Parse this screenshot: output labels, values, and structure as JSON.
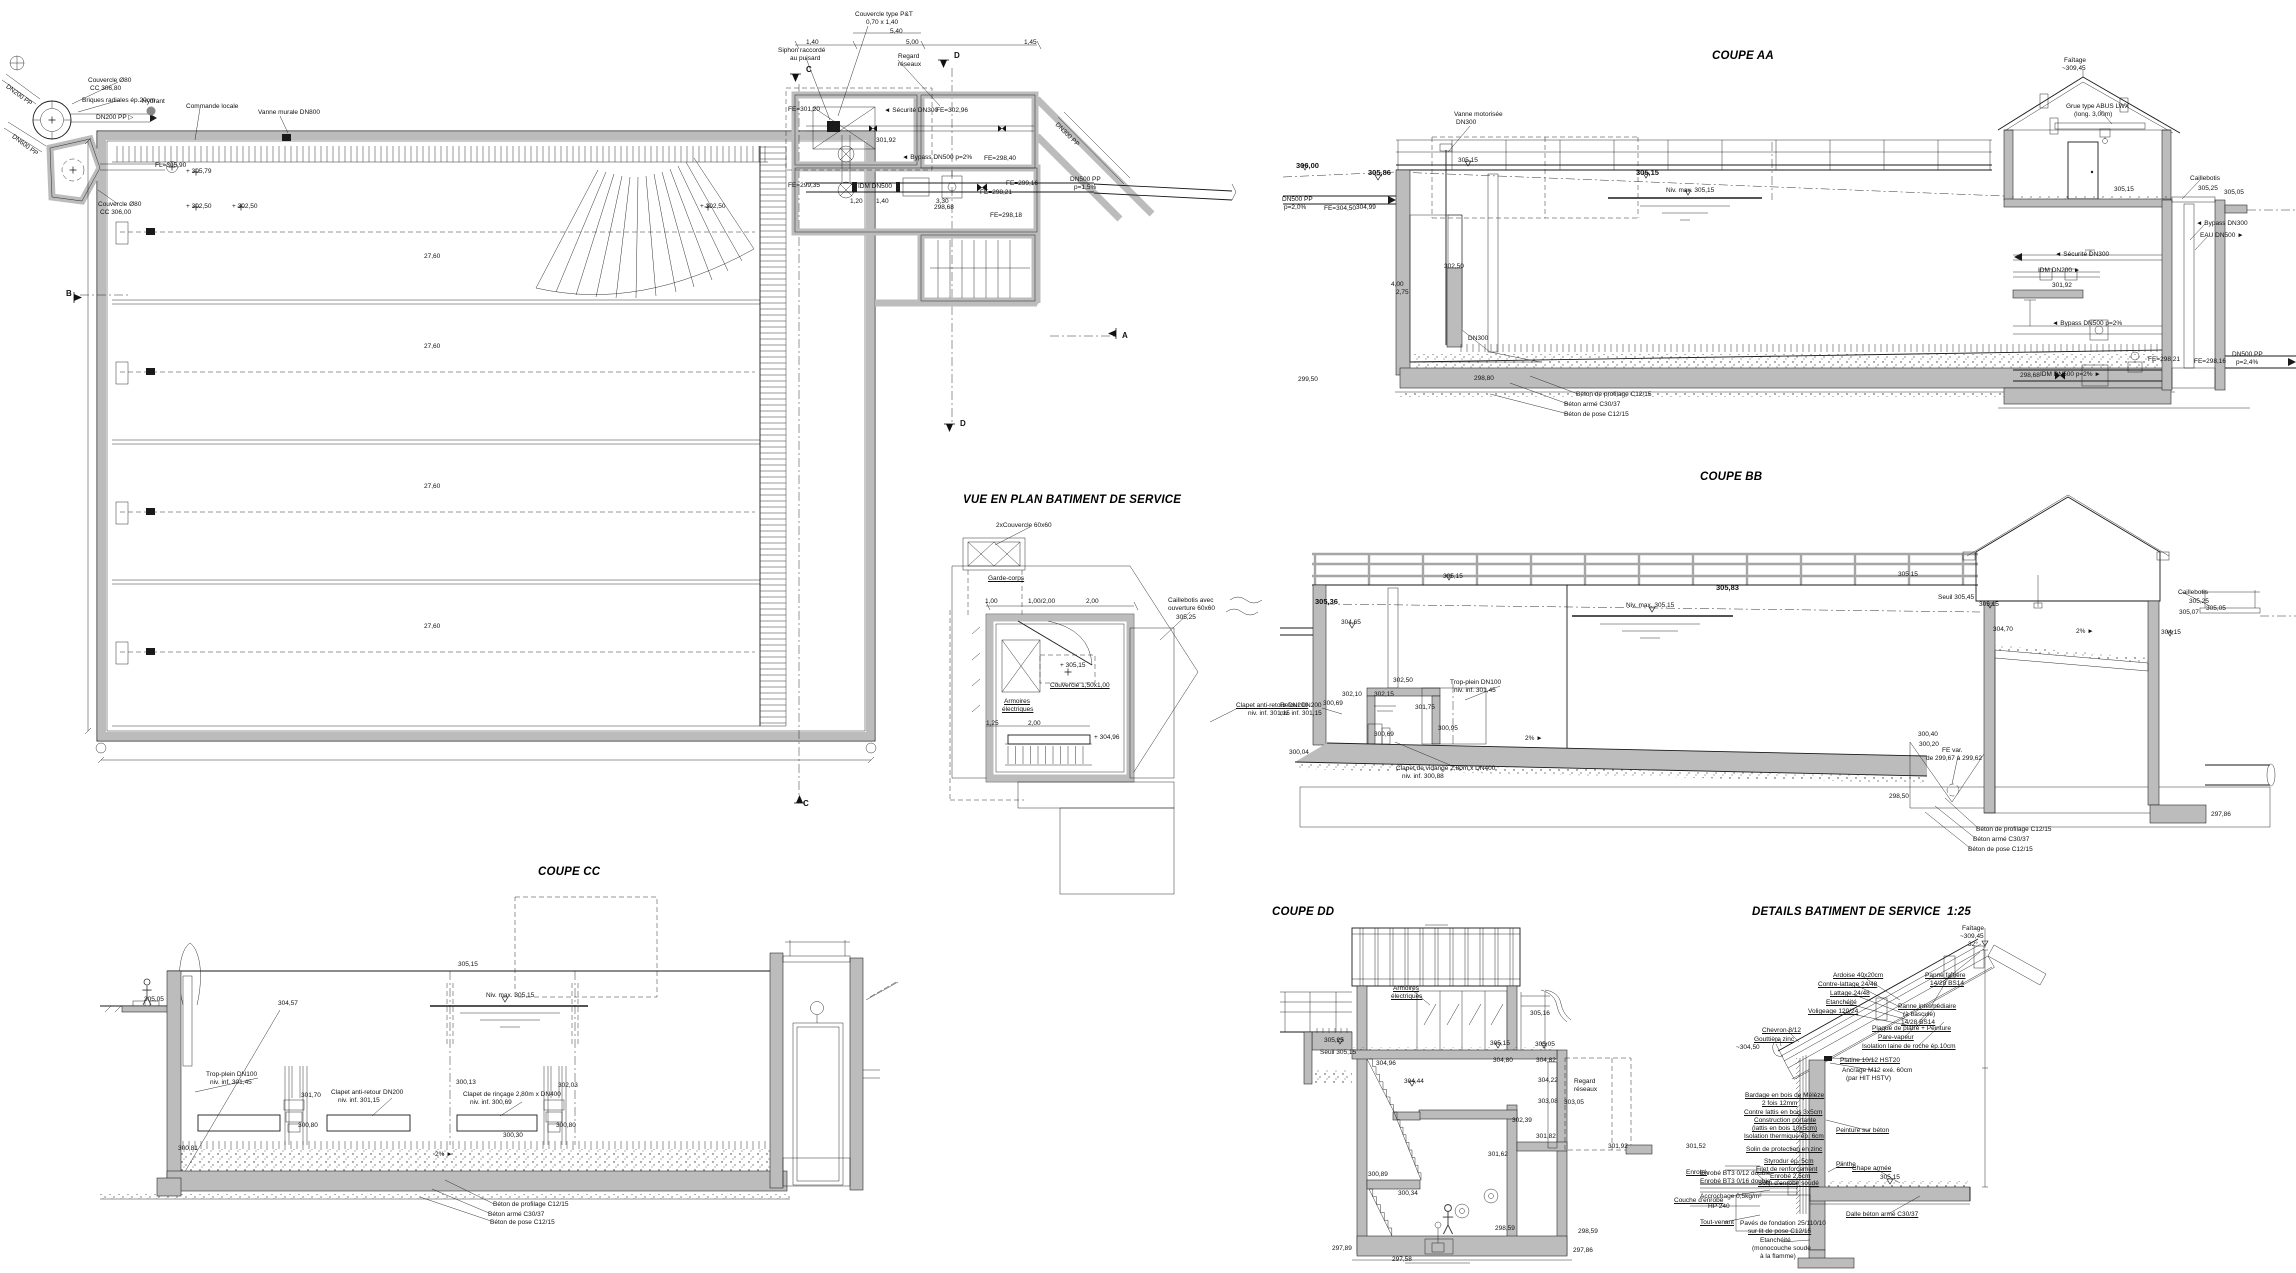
{
  "meta": {
    "paper_color": "#ffffff",
    "ink_color": "#1a1a1a",
    "concrete_color": "#bcbcbc",
    "railing_color": "#a6a6a6",
    "drawing_type": "water reservoir / basin construction drawing"
  },
  "titles": {
    "coupe_aa": "COUPE AA",
    "coupe_bb": "COUPE BB",
    "coupe_cc": "COUPE CC",
    "coupe_dd": "COUPE DD",
    "vue_plan_service": "VUE EN PLAN BATIMENT DE SERVICE",
    "details_service": "DETAILS BATIMENT DE SERVICE  1:25"
  },
  "annotations": [
    {
      "t": "Couvercle Ø80",
      "x": 88,
      "y": 78
    },
    {
      "t": "CC 306,80",
      "x": 90,
      "y": 86
    },
    {
      "t": "Briques radiales ép.20cm",
      "x": 82,
      "y": 98
    },
    {
      "t": "Hydrant",
      "x": 142,
      "y": 99
    },
    {
      "t": "Commande locale",
      "x": 186,
      "y": 104
    },
    {
      "t": "Vanne murale DN800",
      "x": 258,
      "y": 110
    },
    {
      "t": "DN200 PP ▷",
      "x": 96,
      "y": 115
    },
    {
      "t": "DN200 PP",
      "x": 8,
      "y": 84,
      "r": 37
    },
    {
      "t": "DN600 PP",
      "x": 14,
      "y": 134,
      "r": 37
    },
    {
      "t": "Couvercle Ø80",
      "x": 98,
      "y": 202
    },
    {
      "t": "CC 306,00",
      "x": 100,
      "y": 210
    },
    {
      "t": "FL=305,90",
      "x": 155,
      "y": 163
    },
    {
      "t": "+ 305,79",
      "x": 186,
      "y": 169
    },
    {
      "t": "+ 302,50",
      "x": 186,
      "y": 204
    },
    {
      "t": "+ 302,50",
      "x": 232,
      "y": 204
    },
    {
      "t": "+ 302,50",
      "x": 700,
      "y": 204
    },
    {
      "t": "27,60",
      "x": 424,
      "y": 254
    },
    {
      "t": "27,60",
      "x": 424,
      "y": 344
    },
    {
      "t": "27,60",
      "x": 424,
      "y": 484
    },
    {
      "t": "27,60",
      "x": 424,
      "y": 624
    },
    {
      "t": "B",
      "x": 66,
      "y": 290,
      "b": true,
      "s": 8
    },
    {
      "t": "A",
      "x": 1122,
      "y": 332,
      "b": true,
      "s": 8
    },
    {
      "t": "C",
      "x": 806,
      "y": 66,
      "b": true,
      "s": 8
    },
    {
      "t": "D",
      "x": 954,
      "y": 52,
      "b": true,
      "s": 8
    },
    {
      "t": "D",
      "x": 960,
      "y": 420,
      "b": true,
      "s": 8
    },
    {
      "t": "C",
      "x": 803,
      "y": 800,
      "b": true,
      "s": 8
    },
    {
      "t": "Couvercle type P&T",
      "x": 855,
      "y": 12
    },
    {
      "t": "0,70 x 1,40",
      "x": 866,
      "y": 20
    },
    {
      "t": "5,40",
      "x": 890,
      "y": 29
    },
    {
      "t": "1,40",
      "x": 806,
      "y": 40
    },
    {
      "t": "5,00",
      "x": 906,
      "y": 40
    },
    {
      "t": "1,45",
      "x": 1024,
      "y": 40
    },
    {
      "t": "Siphon raccordé",
      "x": 778,
      "y": 48
    },
    {
      "t": "au puisard",
      "x": 790,
      "y": 56
    },
    {
      "t": "Regard",
      "x": 898,
      "y": 54
    },
    {
      "t": "réseaux",
      "x": 898,
      "y": 62
    },
    {
      "t": "FE=301,20",
      "x": 788,
      "y": 107
    },
    {
      "t": "◄ Sécurité DN300",
      "x": 884,
      "y": 108
    },
    {
      "t": "FE=302,96",
      "x": 936,
      "y": 108
    },
    {
      "t": "301,92",
      "x": 876,
      "y": 138
    },
    {
      "t": "◄ Bypass DN500 p=2%",
      "x": 902,
      "y": 155
    },
    {
      "t": "FE=299,35",
      "x": 788,
      "y": 183
    },
    {
      "t": "IDM DN500",
      "x": 858,
      "y": 184
    },
    {
      "t": "FE=298,40",
      "x": 984,
      "y": 156
    },
    {
      "t": "FE=298,21",
      "x": 980,
      "y": 190
    },
    {
      "t": "FE=299,16",
      "x": 1006,
      "y": 181
    },
    {
      "t": "FE=298,18",
      "x": 990,
      "y": 213
    },
    {
      "t": "298,68",
      "x": 934,
      "y": 205
    },
    {
      "t": "1,20",
      "x": 850,
      "y": 199
    },
    {
      "t": "1,40",
      "x": 876,
      "y": 199
    },
    {
      "t": "3,30",
      "x": 936,
      "y": 199
    },
    {
      "t": "DN500 PP",
      "x": 1070,
      "y": 177
    },
    {
      "t": "p=1,5%",
      "x": 1074,
      "y": 185
    },
    {
      "t": "DN300 PP",
      "x": 1058,
      "y": 122,
      "r": 45
    },
    {
      "t": "2xCouvercle 60x60",
      "x": 996,
      "y": 523
    },
    {
      "t": "Garde-corps",
      "x": 988,
      "y": 576,
      "u": true
    },
    {
      "t": "Caillebotis avec",
      "x": 1168,
      "y": 598
    },
    {
      "t": "ouverture 60x60",
      "x": 1168,
      "y": 606
    },
    {
      "t": "305,25",
      "x": 1176,
      "y": 615
    },
    {
      "t": "1,00",
      "x": 985,
      "y": 599
    },
    {
      "t": "1,00/2,00",
      "x": 1028,
      "y": 599
    },
    {
      "t": "2,00",
      "x": 1086,
      "y": 599
    },
    {
      "t": "+ 305,15",
      "x": 1060,
      "y": 663
    },
    {
      "t": "Couvercle 1,50x1,00",
      "x": 1050,
      "y": 683,
      "u": true
    },
    {
      "t": "Armoires",
      "x": 1004,
      "y": 699,
      "u": true
    },
    {
      "t": "électriques",
      "x": 1002,
      "y": 707,
      "u": true
    },
    {
      "t": "1,25",
      "x": 986,
      "y": 721
    },
    {
      "t": "2,00",
      "x": 1028,
      "y": 721
    },
    {
      "t": "+ 304,96",
      "x": 1094,
      "y": 735
    },
    {
      "t": "Clapet anti-retour DN200",
      "x": 1236,
      "y": 703,
      "u": true
    },
    {
      "t": "niv. inf. 301,15",
      "x": 1248,
      "y": 711
    },
    {
      "t": "Vanne motorisée",
      "x": 1454,
      "y": 112
    },
    {
      "t": "DN300",
      "x": 1456,
      "y": 120
    },
    {
      "t": "306,00",
      "x": 1296,
      "y": 162,
      "b": true
    },
    {
      "t": "305,86",
      "x": 1368,
      "y": 169,
      "b": true
    },
    {
      "t": "305,15",
      "x": 1458,
      "y": 158
    },
    {
      "t": "305,15",
      "x": 1636,
      "y": 169,
      "b": true
    },
    {
      "t": "Niv. max. 305,15",
      "x": 1666,
      "y": 188
    },
    {
      "t": "DN500 PP",
      "x": 1282,
      "y": 197
    },
    {
      "t": "p=2,0%",
      "x": 1284,
      "y": 205
    },
    {
      "t": "FE=304,50",
      "x": 1324,
      "y": 206
    },
    {
      "t": "304,99",
      "x": 1356,
      "y": 205
    },
    {
      "t": "302,50",
      "x": 1444,
      "y": 264
    },
    {
      "t": "4,00",
      "x": 1391,
      "y": 282
    },
    {
      "t": "2,75",
      "x": 1396,
      "y": 290
    },
    {
      "t": "DN300",
      "x": 1468,
      "y": 336
    },
    {
      "t": "299,50",
      "x": 1298,
      "y": 377
    },
    {
      "t": "298,80",
      "x": 1474,
      "y": 376
    },
    {
      "t": "Béton de profilage C12/15",
      "x": 1576,
      "y": 392
    },
    {
      "t": "Béton armé C30/37",
      "x": 1564,
      "y": 402
    },
    {
      "t": "Béton de pose C12/15",
      "x": 1564,
      "y": 412
    },
    {
      "t": "Faîtage",
      "x": 2064,
      "y": 58
    },
    {
      "t": "~309,45",
      "x": 2062,
      "y": 66
    },
    {
      "t": "Grue type ABUS LWX",
      "x": 2066,
      "y": 104
    },
    {
      "t": "(long. 3,00m)",
      "x": 2074,
      "y": 112
    },
    {
      "t": "Caillebotis",
      "x": 2190,
      "y": 176
    },
    {
      "t": "305,15",
      "x": 2114,
      "y": 187
    },
    {
      "t": "305,25",
      "x": 2198,
      "y": 186
    },
    {
      "t": "305,05",
      "x": 2224,
      "y": 190
    },
    {
      "t": "◄ Sécurité DN300",
      "x": 2055,
      "y": 252
    },
    {
      "t": "IDM DN200 ►",
      "x": 2038,
      "y": 268
    },
    {
      "t": "301,92",
      "x": 2052,
      "y": 283
    },
    {
      "t": "◄ Bypass DN500 p=2%",
      "x": 2052,
      "y": 321
    },
    {
      "t": "◄ Bypass DN300",
      "x": 2196,
      "y": 221
    },
    {
      "t": "EAU DN500 ►",
      "x": 2200,
      "y": 233
    },
    {
      "t": "IDM DN500 p=2% ►",
      "x": 2040,
      "y": 372
    },
    {
      "t": "298,68",
      "x": 2020,
      "y": 373
    },
    {
      "t": "FE=298,21",
      "x": 2148,
      "y": 357
    },
    {
      "t": "FE=298,16",
      "x": 2194,
      "y": 359
    },
    {
      "t": "DN500 PP",
      "x": 2232,
      "y": 352
    },
    {
      "t": "p=2,4%",
      "x": 2236,
      "y": 360
    },
    {
      "t": "305,15",
      "x": 1443,
      "y": 574
    },
    {
      "t": "305,36",
      "x": 1315,
      "y": 598,
      "b": true
    },
    {
      "t": "Niv. max. 305,15",
      "x": 1626,
      "y": 603
    },
    {
      "t": "305,83",
      "x": 1716,
      "y": 584,
      "b": true
    },
    {
      "t": "304,65",
      "x": 1341,
      "y": 620
    },
    {
      "t": "302,50",
      "x": 1393,
      "y": 678
    },
    {
      "t": "Trop-plein DN100",
      "x": 1450,
      "y": 680
    },
    {
      "t": "niv. inf. 301,45",
      "x": 1454,
      "y": 688
    },
    {
      "t": "302,10",
      "x": 1342,
      "y": 692
    },
    {
      "t": "302,15",
      "x": 1374,
      "y": 692
    },
    {
      "t": "300,69",
      "x": 1323,
      "y": 701
    },
    {
      "t": "Retour DN200",
      "x": 1280,
      "y": 703
    },
    {
      "t": "niv. inf. 301,15",
      "x": 1280,
      "y": 711
    },
    {
      "t": "301,75",
      "x": 1415,
      "y": 705
    },
    {
      "t": "300,95",
      "x": 1438,
      "y": 726
    },
    {
      "t": "300,69",
      "x": 1374,
      "y": 732
    },
    {
      "t": "2% ►",
      "x": 1525,
      "y": 736
    },
    {
      "t": "300,04",
      "x": 1289,
      "y": 750
    },
    {
      "t": "Clapet de vidange 2,80m x DN400",
      "x": 1396,
      "y": 766
    },
    {
      "t": "niv. inf. 300,88",
      "x": 1402,
      "y": 774
    },
    {
      "t": "305,15",
      "x": 1898,
      "y": 572
    },
    {
      "t": "Seuil 305,45",
      "x": 1938,
      "y": 595
    },
    {
      "t": "305,15",
      "x": 1979,
      "y": 602
    },
    {
      "t": "Caillebotis",
      "x": 2178,
      "y": 590
    },
    {
      "t": "305,25",
      "x": 2189,
      "y": 599
    },
    {
      "t": "305,07",
      "x": 2179,
      "y": 610
    },
    {
      "t": "305,05",
      "x": 2206,
      "y": 606
    },
    {
      "t": "304,70",
      "x": 1993,
      "y": 627
    },
    {
      "t": "2% ►",
      "x": 2076,
      "y": 629
    },
    {
      "t": "304,15",
      "x": 2161,
      "y": 630
    },
    {
      "t": "300,40",
      "x": 1918,
      "y": 732
    },
    {
      "t": "300,20",
      "x": 1919,
      "y": 742
    },
    {
      "t": "FE var.",
      "x": 1942,
      "y": 748
    },
    {
      "t": "de 299,67 à 299,62",
      "x": 1926,
      "y": 756
    },
    {
      "t": "298,50",
      "x": 1889,
      "y": 794
    },
    {
      "t": "297,86",
      "x": 2211,
      "y": 812
    },
    {
      "t": "Béton de profilage C12/15",
      "x": 1976,
      "y": 827
    },
    {
      "t": "Béton armé C30/37",
      "x": 1973,
      "y": 837
    },
    {
      "t": "Béton de pose C12/15",
      "x": 1968,
      "y": 847
    },
    {
      "t": "305,05",
      "x": 144,
      "y": 997
    },
    {
      "t": "305,15",
      "x": 458,
      "y": 962
    },
    {
      "t": "Niv. max. 305,15",
      "x": 486,
      "y": 993
    },
    {
      "t": "304,57",
      "x": 278,
      "y": 1001
    },
    {
      "t": "Trop-plein DN100",
      "x": 206,
      "y": 1072
    },
    {
      "t": "niv. inf. 301,45",
      "x": 210,
      "y": 1080
    },
    {
      "t": "301,70",
      "x": 301,
      "y": 1093
    },
    {
      "t": "Clapet anti-retour DN200",
      "x": 331,
      "y": 1090
    },
    {
      "t": "niv. inf. 301,15",
      "x": 338,
      "y": 1098
    },
    {
      "t": "300,13",
      "x": 456,
      "y": 1080
    },
    {
      "t": "302,03",
      "x": 558,
      "y": 1083
    },
    {
      "t": "Clapet de rinçage 2,80m x DN400",
      "x": 463,
      "y": 1092
    },
    {
      "t": "niv. inf. 300,69",
      "x": 470,
      "y": 1100
    },
    {
      "t": "300,80",
      "x": 298,
      "y": 1123
    },
    {
      "t": "300,80",
      "x": 556,
      "y": 1123
    },
    {
      "t": "300,30",
      "x": 503,
      "y": 1133
    },
    {
      "t": "300,81",
      "x": 178,
      "y": 1146
    },
    {
      "t": "2% ►",
      "x": 435,
      "y": 1152
    },
    {
      "t": "Béton de profilage C12/15",
      "x": 493,
      "y": 1202
    },
    {
      "t": "Béton armé C30/37",
      "x": 488,
      "y": 1212
    },
    {
      "t": "Béton de pose C12/15",
      "x": 490,
      "y": 1220
    },
    {
      "t": "Armoires",
      "x": 1393,
      "y": 986,
      "u": true
    },
    {
      "t": "électriques",
      "x": 1391,
      "y": 994,
      "u": true
    },
    {
      "t": "305,25",
      "x": 1324,
      "y": 1038
    },
    {
      "t": "Seuil 305,15",
      "x": 1320,
      "y": 1050
    },
    {
      "t": "305,15",
      "x": 1490,
      "y": 1041
    },
    {
      "t": "305,16",
      "x": 1530,
      "y": 1011
    },
    {
      "t": "305,05",
      "x": 1535,
      "y": 1042
    },
    {
      "t": "304,96",
      "x": 1376,
      "y": 1061
    },
    {
      "t": "304,80",
      "x": 1493,
      "y": 1058
    },
    {
      "t": "304,82",
      "x": 1536,
      "y": 1058
    },
    {
      "t": "304,44",
      "x": 1404,
      "y": 1079
    },
    {
      "t": "304,22",
      "x": 1538,
      "y": 1078
    },
    {
      "t": "Regard",
      "x": 1574,
      "y": 1079
    },
    {
      "t": "réseaux",
      "x": 1574,
      "y": 1087
    },
    {
      "t": "303,08",
      "x": 1538,
      "y": 1099
    },
    {
      "t": "303,05",
      "x": 1564,
      "y": 1100
    },
    {
      "t": "302,39",
      "x": 1512,
      "y": 1118
    },
    {
      "t": "301,82",
      "x": 1536,
      "y": 1134
    },
    {
      "t": "301,92",
      "x": 1608,
      "y": 1144
    },
    {
      "t": "301,62",
      "x": 1488,
      "y": 1152
    },
    {
      "t": "301,52",
      "x": 1686,
      "y": 1144
    },
    {
      "t": "300,89",
      "x": 1368,
      "y": 1172
    },
    {
      "t": "300,34",
      "x": 1398,
      "y": 1191
    },
    {
      "t": "298,59",
      "x": 1495,
      "y": 1226
    },
    {
      "t": "298,59",
      "x": 1578,
      "y": 1229
    },
    {
      "t": "297,89",
      "x": 1332,
      "y": 1246
    },
    {
      "t": "297,86",
      "x": 1573,
      "y": 1248
    },
    {
      "t": "297,58",
      "x": 1392,
      "y": 1257
    },
    {
      "t": "Enrobé",
      "x": 1686,
      "y": 1170,
      "u": true
    },
    {
      "t": "Couche d'enrobé",
      "x": 1674,
      "y": 1198,
      "u": true
    },
    {
      "t": "Faîtage",
      "x": 1962,
      "y": 926
    },
    {
      "t": "~309,45",
      "x": 1960,
      "y": 934
    },
    {
      "t": "32°",
      "x": 1968,
      "y": 942
    },
    {
      "t": "Ardoise 40x20cm",
      "x": 1833,
      "y": 973,
      "u": true
    },
    {
      "t": "Contre-lattage 24/48",
      "x": 1818,
      "y": 982,
      "u": true
    },
    {
      "t": "Lattage 24/48",
      "x": 1830,
      "y": 991,
      "u": true
    },
    {
      "t": "Etanchéité",
      "x": 1826,
      "y": 1000,
      "u": true
    },
    {
      "t": "Voligeage 120/24",
      "x": 1808,
      "y": 1009,
      "u": true
    },
    {
      "t": "Panne faîtière",
      "x": 1925,
      "y": 973,
      "u": true
    },
    {
      "t": "14/28 BS14",
      "x": 1930,
      "y": 981,
      "u": true
    },
    {
      "t": "Panne intermédiaire",
      "x": 1898,
      "y": 1004,
      "u": true
    },
    {
      "t": "(à bascule)",
      "x": 1903,
      "y": 1012
    },
    {
      "t": "14/28 BS14",
      "x": 1901,
      "y": 1020,
      "u": true
    },
    {
      "t": "Plaque de plâtre + Peinture",
      "x": 1872,
      "y": 1026,
      "u": true
    },
    {
      "t": "Pare-vapeur",
      "x": 1878,
      "y": 1035,
      "u": true
    },
    {
      "t": "Isolation laine de roche ép.10cm",
      "x": 1862,
      "y": 1044,
      "u": true
    },
    {
      "t": "Chevron 8/12",
      "x": 1762,
      "y": 1028,
      "u": true
    },
    {
      "t": "Gouttière zinc",
      "x": 1754,
      "y": 1037,
      "u": true
    },
    {
      "t": "~304,50",
      "x": 1736,
      "y": 1045
    },
    {
      "t": "Platine 10/12 HST20",
      "x": 1840,
      "y": 1058,
      "u": true
    },
    {
      "t": "Ancrage M12 exé. 60cm",
      "x": 1842,
      "y": 1068
    },
    {
      "t": "(par HIT HSTV)",
      "x": 1846,
      "y": 1076
    },
    {
      "t": "Bardage en bois de Mélèze",
      "x": 1745,
      "y": 1093,
      "u": true
    },
    {
      "t": "2 fois 12mm",
      "x": 1762,
      "y": 1101,
      "u": true
    },
    {
      "t": "Contre lattis en bois 3x5cm",
      "x": 1744,
      "y": 1110,
      "u": true
    },
    {
      "t": "Construction portante",
      "x": 1754,
      "y": 1118,
      "u": true
    },
    {
      "t": "(lattis en bois 10x5cm)",
      "x": 1752,
      "y": 1126,
      "u": true
    },
    {
      "t": "Isolation thermique ép. 6cm",
      "x": 1744,
      "y": 1134,
      "u": true
    },
    {
      "t": "Solin de protection en zinc",
      "x": 1746,
      "y": 1147,
      "u": true
    },
    {
      "t": "Styrodur ép. 5cm",
      "x": 1764,
      "y": 1159,
      "u": true
    },
    {
      "t": "Filet de renforcement",
      "x": 1756,
      "y": 1167,
      "u": true
    },
    {
      "t": "Enrobé 2,5cm",
      "x": 1770,
      "y": 1174,
      "u": true
    },
    {
      "t": "Solin d'enrobé soudé",
      "x": 1758,
      "y": 1181,
      "u": true
    },
    {
      "t": "Peinture sur béton",
      "x": 1836,
      "y": 1128,
      "u": true
    },
    {
      "t": "Plinthe",
      "x": 1836,
      "y": 1162,
      "u": true
    },
    {
      "t": "Chape armée",
      "x": 1852,
      "y": 1166,
      "u": true
    },
    {
      "t": "305,15",
      "x": 1880,
      "y": 1175
    },
    {
      "t": "Dalle béton armé C30/37",
      "x": 1846,
      "y": 1212,
      "u": true
    },
    {
      "t": "Enrobé BT3 0/12 double",
      "x": 1700,
      "y": 1171
    },
    {
      "t": "Enrobé BT3 0/16 double",
      "x": 1700,
      "y": 1179
    },
    {
      "t": "Accrochage 0,5kg/m²",
      "x": 1700,
      "y": 1194
    },
    {
      "t": "HP 240",
      "x": 1708,
      "y": 1204
    },
    {
      "t": "Tout-venant",
      "x": 1700,
      "y": 1220,
      "u": true
    },
    {
      "t": "Pavés de fondation 25/110/10",
      "x": 1740,
      "y": 1221
    },
    {
      "t": "sur lit de pose C12/15",
      "x": 1748,
      "y": 1229,
      "u": true
    },
    {
      "t": "Etanchéité",
      "x": 1760,
      "y": 1238
    },
    {
      "t": "(monocouche soudé",
      "x": 1752,
      "y": 1246
    },
    {
      "t": "à la flamme)",
      "x": 1760,
      "y": 1254
    }
  ]
}
